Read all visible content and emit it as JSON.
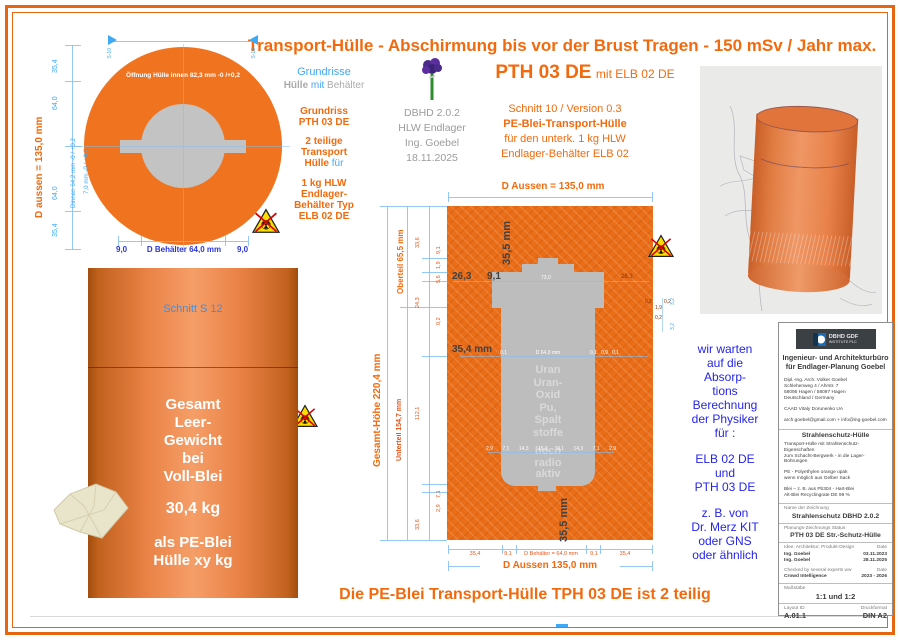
{
  "colors": {
    "accent_orange": "#f26a0d",
    "drawing_orange": "#f0741f",
    "dim_blue": "#3fa9f5",
    "note_blue": "#2525e8",
    "container_gray": "#bdbdbd"
  },
  "header": {
    "title": "Transport-Hülle - Abschirmung bis vor der Brust Tragen - 150 mSv / Jahr max."
  },
  "plan": {
    "s10": "S-10",
    "s12": "S-12",
    "d_aussen": "D aussen = 135,0 mm",
    "dim_354_top": "35,4",
    "dim_640_top": "64,0",
    "dim_640_bot": "64,0",
    "dim_354_bot": "35,4",
    "dinnen": "Dinnen 64,2 mm -0 / +0,2",
    "d7": "7,0 mm -0 / +0,2",
    "opening": "Öffnung Hülle innen 82,3 mm -0 /+0,2",
    "b_left": "9,0",
    "b_center": "D Behälter 64,0 mm",
    "b_right": "9,0"
  },
  "legend": {
    "grundrisse": "Grundrisse",
    "huelle": "Hülle",
    "mit": "mit",
    "behaelter": "Behälter"
  },
  "note_grundriss": {
    "l1": "Grundriss",
    "l2": "PTH 03 DE",
    "l3": "2 teilige",
    "l4": "Transport",
    "l5": "Hülle",
    "l5b": " für",
    "l6": "1 kg HLW",
    "l7": "Endlager-",
    "l8": "Behälter Typ",
    "l9": "ELB 02 DE"
  },
  "meta": {
    "l1": "DBHD 2.0.2",
    "l2": "HLW Endlager",
    "l3": "Ing. Goebel",
    "l4": "18.11.2025"
  },
  "pth": {
    "title": "PTH 03 DE",
    "subtitle": "mit ELB 02 DE"
  },
  "schnitt_note": {
    "l1": "Schnitt 10 / Version 0.3",
    "l2": "PE-Blei-Transport-Hülle",
    "l3": "für den unterk. 1 kg HLW",
    "l4": "Endlager-Behälter ELB 02"
  },
  "section": {
    "d_aussen_top": "D Aussen = 135,0 mm",
    "dim_355_top": "35,5 mm",
    "dim_263_left": "26,3",
    "dim_91": "9,1",
    "dim_730": "73,0",
    "dim_263_right": "26,3",
    "dim_354": "35,4 mm",
    "mid_dims": {
      "m1": "0,1",
      "m2": "D 64,0 mm",
      "m3": "0,1",
      "m4": "0,9",
      "m5": "0,1"
    },
    "content": {
      "c1": "Uran",
      "c2": "Uran-",
      "c3": "Oxid",
      "c4": "Pu,",
      "c5": "Spalt",
      "c6": "stoffe",
      "c7": "hoch",
      "c8": "radio",
      "c9": "aktiv"
    },
    "oberteil": "Oberteil 65,5 mm",
    "gesamt": "Gesamt-Höhe  220,4 mm",
    "unterteil": "Unterteil 154,7 mm",
    "chain": {
      "a1": "33,6",
      "a2": "24,3",
      "a3": "112,1",
      "a4": "33,6",
      "b1": "9,1",
      "b2": "1,9",
      "b3": "5,6",
      "b4": "0,2",
      "b5": "7,1",
      "b6": "2,9"
    },
    "right_cluster": {
      "r1": "0,2",
      "r2": "1,9",
      "r3": "0,2",
      "r4": "0,2",
      "r5": "3,2",
      "r6": "3,2"
    },
    "lower_dims": {
      "d1": "2,9",
      "d2": "7,1",
      "d3": "14,3",
      "d4": "15,3",
      "d5": "0,1",
      "d6": "14,3",
      "d7": "7,1",
      "d8": "2,9"
    },
    "bottom_row": {
      "b1": "35,4",
      "b2": "9,1",
      "b3": "D Behälter = 64,0 mm",
      "b4": "9,1",
      "b5": "35,4"
    },
    "dim_355_bottom": "35,5 mm",
    "d_aussen_bottom": "D Aussen 135,0 mm"
  },
  "cylinder": {
    "schnitt": "Schnitt S 12",
    "l1": "Gesamt",
    "l2": "Leer-",
    "l3": "Gewicht",
    "l4": "bei",
    "l5": "Voll-Blei",
    "weight": "30,4 kg",
    "l6": "als PE-Blei",
    "l7": "Hülle xy kg"
  },
  "waiting": {
    "w1": "wir warten",
    "w2": "auf die",
    "w3": "Absorp-",
    "w4": "tions",
    "w5": "Berechnung",
    "w6": "der Physiker",
    "w7": "für :",
    "w8": "ELB 02 DE",
    "w9": "und",
    "w10": "PTH 03 DE",
    "w11": "z. B. von",
    "w12": "Dr. Merz KIT",
    "w13": "oder GNS",
    "w14": "oder ähnlich"
  },
  "titleblock": {
    "logo1": "DBHD GDF",
    "logo2": "INSTITUTE PLC",
    "firm1": "Ingenieur- und Architekturbüro",
    "firm2": "für Endlager-Planung Goebel",
    "addr1": "Dipl.-Ing. Arch. Volker Goebel",
    "addr2": "Schlehenweg 4 / Ahrstr. 7",
    "addr3": "58095 Hagen / 58097 Hagen",
    "addr4": "Deutschland / Germany",
    "addr5": "CAAD Vitaly Dorunenko UA",
    "addr6": "arch.goebel@gmail.com + info@ing-goebel.com",
    "sec_title": "Strahlenschutz-Hülle",
    "p1a": "Transport-Hülle mit Strahlenschutz-Eigenschaften",
    "p1b": "zum Schacht-Bergwerk - in die Lager-Bohrungen",
    "p2a": "PE - Polyethylen orange opak",
    "p2b": "wenn möglich aus Gelber Sack",
    "p3a": "Blei – z. B. aus Pb304 - Hart-Blei",
    "p3b": "Alt-Blei Recyclingrate DE 99 %",
    "name_label": "Name der Zeichnung",
    "name_value": "Strahlenschutz DBHD 2.0.2",
    "status_label": "Planungs-Zeichnungs Status",
    "status_value": "PTH 03 DE Str.-Schutz-Hülle",
    "row1l": "Idee, Architektur, Produkt-Design",
    "row1r": "Date",
    "row2l": "Ing. Goebel",
    "row2r": "03.11.2023",
    "row3l": "Ing. Goebel",
    "row3r": "28.11.2025",
    "row4l": "Checked by several experts ww",
    "row4r": "Date",
    "row5l": "Crowd Intelligence",
    "row5r": "2023 - 2026",
    "scale_label": "Maßstäbe",
    "scale_value": "1:1 und 1:2",
    "layout_label": "Layout ID",
    "format_label": "Druckformat",
    "layout_value": "A.01.1",
    "format_value": "DIN A2"
  },
  "footer": {
    "text": "Die PE-Blei Transport-Hülle TPH 03 DE ist 2 teilig"
  }
}
